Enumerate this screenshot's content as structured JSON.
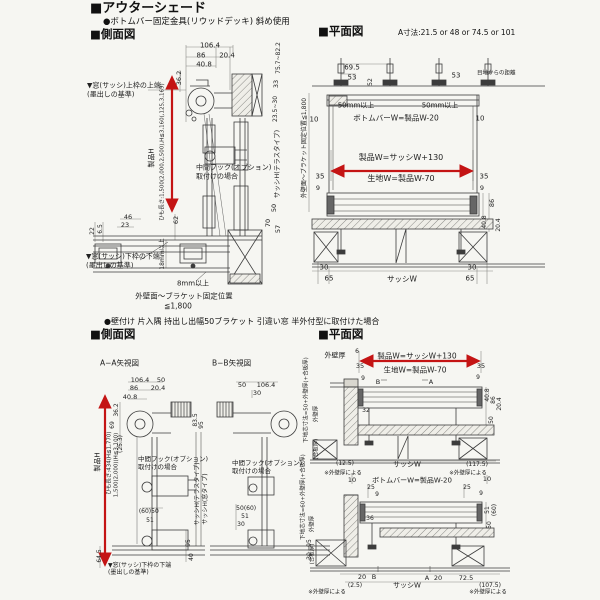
{
  "header": {
    "title": "■アウターシェード",
    "subtitle": "●ボトムバー固定金具(リウッドデッキ) 斜め使用"
  },
  "section1": {
    "side_label": "■側面図",
    "plan_label": "■平面図",
    "a_note": "A寸法:21.5 or 48 or 74.5 or 101"
  },
  "section2": {
    "heading": "●壁付け 片入隅 持出し出幅50ブラケット 引違い窓 半外付型に取付けた場合",
    "side_label": "■側面図",
    "plan_label": "■平面図"
  },
  "colors": {
    "line": "#3c3c3c",
    "dim": "#8a8a86",
    "red": "#c41414",
    "paper": "#f6f6f2"
  },
  "labels": [
    {
      "n": "sv1-dim-total-width",
      "t": "106.4",
      "x": 210,
      "y": 46,
      "s": 7
    },
    {
      "n": "sv1-dim-86",
      "t": "86",
      "x": 201,
      "y": 56,
      "s": 7
    },
    {
      "n": "sv1-dim-20-4",
      "t": "20.4",
      "x": 227,
      "y": 56,
      "s": 7
    },
    {
      "n": "sv1-dim-40-8",
      "t": "40.8",
      "x": 204,
      "y": 65,
      "s": 7
    },
    {
      "n": "sv1-dim-36-2",
      "t": "36.2",
      "x": 179,
      "y": 78,
      "s": 6.5,
      "r": 1
    },
    {
      "n": "sv1-note-upper-1",
      "t": "▼窓(サッシ)上枠の上端",
      "x": 87,
      "y": 86,
      "s": 7,
      "a": "l"
    },
    {
      "n": "sv1-note-upper-2",
      "t": "(墨出しの基準)",
      "x": 87,
      "y": 95,
      "s": 7,
      "a": "l"
    },
    {
      "n": "sv1-product-h",
      "t": "製品H",
      "x": 152,
      "y": 158,
      "s": 7,
      "r": 1
    },
    {
      "n": "sv1-cord-length",
      "t": "ひも長さ:1,500(2,000,2,500),H≦3,160(,125,3,169)",
      "x": 163,
      "y": 152,
      "s": 5.5,
      "r": 1
    },
    {
      "n": "sv1-midhook-1",
      "t": "中間フック(オプション)",
      "x": 196,
      "y": 168,
      "s": 7,
      "a": "l"
    },
    {
      "n": "sv1-midhook-2",
      "t": "取付けの場合",
      "x": 196,
      "y": 177,
      "s": 7,
      "a": "l"
    },
    {
      "n": "sv1-note-lower-1",
      "t": "▼窓(サッシ)下枠の下端",
      "x": 86,
      "y": 257,
      "s": 7,
      "a": "l"
    },
    {
      "n": "sv1-note-lower-2",
      "t": "(墨出しの基準)",
      "x": 86,
      "y": 266,
      "s": 7,
      "a": "l"
    },
    {
      "n": "sv1-dim-46",
      "t": "46",
      "x": 128,
      "y": 217,
      "s": 6.5
    },
    {
      "n": "sv1-dim-23",
      "t": "23",
      "x": 125,
      "y": 225,
      "s": 6.5
    },
    {
      "n": "sv1-dim-22",
      "t": "22",
      "x": 93,
      "y": 231,
      "s": 6,
      "r": 1
    },
    {
      "n": "sv1-dim-6-5",
      "t": "6.5",
      "x": 101,
      "y": 229,
      "s": 6,
      "r": 1
    },
    {
      "n": "sv1-dim-62",
      "t": "62",
      "x": 176,
      "y": 220,
      "s": 6.5,
      "r": 1
    },
    {
      "n": "sv1-dim-18mm",
      "t": "18mm以上",
      "x": 163,
      "y": 254,
      "s": 6,
      "r": 1
    },
    {
      "n": "sv1-dim-8mm",
      "t": "8mm以上",
      "x": 193,
      "y": 284,
      "s": 7
    },
    {
      "n": "sv1-fix-note-1",
      "t": "外壁面〜ブラケット固定位置",
      "x": 184,
      "y": 296,
      "s": 7.5
    },
    {
      "n": "sv1-fix-note-2",
      "t": "≦1,800",
      "x": 178,
      "y": 306,
      "s": 7.5
    },
    {
      "n": "sv1-dim-75-7",
      "t": "75.7~82.2",
      "x": 279,
      "y": 58,
      "s": 6,
      "r": 1
    },
    {
      "n": "sv1-dim-33",
      "t": "33",
      "x": 276,
      "y": 84,
      "s": 6.5,
      "r": 1
    },
    {
      "n": "sv1-dim-23-5",
      "t": "23.5~30",
      "x": 276,
      "y": 109,
      "s": 6,
      "r": 1
    },
    {
      "n": "sv1-sash-h",
      "t": "サッシH(テラスタイプ)",
      "x": 277,
      "y": 164,
      "s": 6.5,
      "r": 1
    },
    {
      "n": "sv1-dim-50",
      "t": "50",
      "x": 274,
      "y": 208,
      "s": 6.5,
      "r": 1
    },
    {
      "n": "sv1-dim-70",
      "t": "70",
      "x": 268,
      "y": 223,
      "s": 6.5,
      "r": 1
    },
    {
      "n": "sv1-dim-57",
      "t": "57",
      "x": 278,
      "y": 229,
      "s": 6.5,
      "r": 1
    },
    {
      "n": "pv1-dim-69-5",
      "t": "69.5",
      "x": 352,
      "y": 68,
      "s": 7
    },
    {
      "n": "pv1-dim-53-left",
      "t": "53",
      "x": 352,
      "y": 78,
      "s": 7
    },
    {
      "n": "pv1-dim-52",
      "t": "52",
      "x": 371,
      "y": 82,
      "s": 6,
      "r": 1
    },
    {
      "n": "pv1-dim-53-right",
      "t": "53",
      "x": 456,
      "y": 76,
      "s": 7
    },
    {
      "n": "pv1-joint-note",
      "t": "目地からの距離",
      "x": 477,
      "y": 74,
      "s": 5.5,
      "a": "l"
    },
    {
      "n": "pv1-50mm-left",
      "t": "50mm以上",
      "x": 356,
      "y": 106,
      "s": 7
    },
    {
      "n": "pv1-50mm-right",
      "t": "50mm以上",
      "x": 440,
      "y": 106,
      "s": 7
    },
    {
      "n": "pv1-bottombar-w",
      "t": "ボトムバーW=製品W-20",
      "x": 396,
      "y": 118,
      "s": 7.5
    },
    {
      "n": "pv1-dim-10-left",
      "t": "10",
      "x": 314,
      "y": 120,
      "s": 7
    },
    {
      "n": "pv1-dim-10-right",
      "t": "10",
      "x": 480,
      "y": 119,
      "s": 7
    },
    {
      "n": "pv1-product-w",
      "t": "製品W=サッシW+130",
      "x": 401,
      "y": 158,
      "s": 8
    },
    {
      "n": "pv1-fabric-w",
      "t": "生地W=製品W-70",
      "x": 401,
      "y": 179,
      "s": 8
    },
    {
      "n": "pv1-dim-35-left",
      "t": "35",
      "x": 320,
      "y": 177,
      "s": 7
    },
    {
      "n": "pv1-dim-35-right",
      "t": "35",
      "x": 484,
      "y": 177,
      "s": 7
    },
    {
      "n": "pv1-dim-9-left",
      "t": "9",
      "x": 318,
      "y": 188,
      "s": 6.5
    },
    {
      "n": "pv1-dim-9-right",
      "t": "9",
      "x": 482,
      "y": 188,
      "s": 6.5
    },
    {
      "n": "pv1-dim-86",
      "t": "86",
      "x": 492,
      "y": 203,
      "s": 6.5,
      "r": 1
    },
    {
      "n": "pv1-dim-40-8",
      "t": "40.8",
      "x": 485,
      "y": 222,
      "s": 6,
      "r": 1
    },
    {
      "n": "pv1-dim-20-4",
      "t": "20.4",
      "x": 499,
      "y": 225,
      "s": 6,
      "r": 1
    },
    {
      "n": "pv1-dim-30-left",
      "t": "30",
      "x": 324,
      "y": 268,
      "s": 7
    },
    {
      "n": "pv1-dim-65-left",
      "t": "65",
      "x": 329,
      "y": 279,
      "s": 7
    },
    {
      "n": "pv1-sash-w",
      "t": "サッシW",
      "x": 402,
      "y": 279,
      "s": 7.5
    },
    {
      "n": "pv1-dim-30-right",
      "t": "30",
      "x": 472,
      "y": 268,
      "s": 7
    },
    {
      "n": "pv1-dim-65-right",
      "t": "65",
      "x": 470,
      "y": 279,
      "s": 7
    },
    {
      "n": "pv1-wall-fix-rot",
      "t": "外壁面〜ブラケット固定位置≦1,800",
      "x": 305,
      "y": 148,
      "s": 6,
      "r": 1
    },
    {
      "n": "ab-aa-title",
      "t": "A−A矢視図",
      "x": 100,
      "y": 363,
      "s": 7.5,
      "a": "l"
    },
    {
      "n": "ab-bb-title",
      "t": "B−B矢視図",
      "x": 212,
      "y": 363,
      "s": 7.5,
      "a": "l"
    },
    {
      "n": "ab-dim-106-4-a",
      "t": "106.4",
      "x": 140,
      "y": 380,
      "s": 6.5
    },
    {
      "n": "ab-dim-50-a",
      "t": "50",
      "x": 161,
      "y": 380,
      "s": 6.5
    },
    {
      "n": "ab-dim-86",
      "t": "86",
      "x": 134,
      "y": 388,
      "s": 6.5
    },
    {
      "n": "ab-dim-20-4",
      "t": "20.4",
      "x": 158,
      "y": 388,
      "s": 6.5
    },
    {
      "n": "ab-dim-40-8",
      "t": "40.8",
      "x": 130,
      "y": 397,
      "s": 6.5
    },
    {
      "n": "ab-dim-36-2",
      "t": "36.2",
      "x": 117,
      "y": 410,
      "s": 6,
      "r": 1
    },
    {
      "n": "ab-dim-69",
      "t": "69",
      "x": 113,
      "y": 425,
      "s": 6,
      "r": 1
    },
    {
      "n": "ab-dim-25-3",
      "t": "(25.3)",
      "x": 121,
      "y": 444,
      "s": 6,
      "r": 1
    },
    {
      "n": "ab-dim-83-5",
      "t": "83.5",
      "x": 196,
      "y": 420,
      "s": 6,
      "r": 1
    },
    {
      "n": "ab-dim-95-a",
      "t": "95",
      "x": 202,
      "y": 425,
      "s": 6,
      "r": 1
    },
    {
      "n": "ab-dim-50-b",
      "t": "50",
      "x": 242,
      "y": 385,
      "s": 6.5
    },
    {
      "n": "ab-dim-106-4-b",
      "t": "106.4",
      "x": 266,
      "y": 385,
      "s": 6.5
    },
    {
      "n": "ab-dim-30-b",
      "t": "30",
      "x": 257,
      "y": 393,
      "s": 6.5
    },
    {
      "n": "ab-midhook-a1",
      "t": "中間フック(オプション)",
      "x": 138,
      "y": 459,
      "s": 6.5,
      "a": "l"
    },
    {
      "n": "ab-midhook-a2",
      "t": "取付けの場合",
      "x": 138,
      "y": 467,
      "s": 6.5,
      "a": "l"
    },
    {
      "n": "ab-midhook-b1",
      "t": "中間フック(オプション)",
      "x": 232,
      "y": 463,
      "s": 6.5,
      "a": "l"
    },
    {
      "n": "ab-midhook-b2",
      "t": "取付けの場合",
      "x": 232,
      "y": 471,
      "s": 6.5,
      "a": "l"
    },
    {
      "n": "ab-product-h",
      "t": "製品H",
      "x": 98,
      "y": 462,
      "s": 7,
      "r": 1
    },
    {
      "n": "ab-cord-1",
      "t": "ひも長さ:434(H≦1,770)",
      "x": 110,
      "y": 463,
      "s": 5.5,
      "r": 1
    },
    {
      "n": "ab-cord-2",
      "t": "1,500(2,000)(H≦3,100)",
      "x": 117,
      "y": 465,
      "s": 5.5,
      "r": 1
    },
    {
      "n": "ab-dim-60-a",
      "t": "(60)",
      "x": 145,
      "y": 512,
      "s": 6
    },
    {
      "n": "ab-dim-50-c",
      "t": "50",
      "x": 155,
      "y": 512,
      "s": 6
    },
    {
      "n": "ab-dim-51-a",
      "t": "51",
      "x": 150,
      "y": 521,
      "s": 6
    },
    {
      "n": "ab-dim-95-b",
      "t": "95",
      "x": 189,
      "y": 543,
      "s": 6,
      "r": 1
    },
    {
      "n": "ab-dim-40",
      "t": "40",
      "x": 192,
      "y": 557,
      "s": 6,
      "r": 1
    },
    {
      "n": "ab-sash-h-terrace",
      "t": "サッシH(テラスタイプ)",
      "x": 198,
      "y": 494,
      "s": 6,
      "r": 1
    },
    {
      "n": "ab-sash-h-window",
      "t": "サッシH(窓タイプ)",
      "x": 206,
      "y": 499,
      "s": 6,
      "r": 1
    },
    {
      "n": "ab-dim-50-d",
      "t": "50",
      "x": 240,
      "y": 509,
      "s": 6
    },
    {
      "n": "ab-dim-60-b",
      "t": "(60)",
      "x": 250,
      "y": 509,
      "s": 6
    },
    {
      "n": "ab-dim-51-b",
      "t": "51",
      "x": 245,
      "y": 517,
      "s": 6
    },
    {
      "n": "ab-dim-30-c",
      "t": "30",
      "x": 241,
      "y": 525,
      "s": 6
    },
    {
      "n": "ab-dim-95-c",
      "t": "95",
      "x": 310,
      "y": 543,
      "s": 6,
      "r": 1
    },
    {
      "n": "ab-dim-30-d",
      "t": "30",
      "x": 310,
      "y": 556,
      "s": 6,
      "r": 1
    },
    {
      "n": "ab-dim-64-5",
      "t": "64.5",
      "x": 100,
      "y": 556,
      "s": 6,
      "r": 1
    },
    {
      "n": "ab-note-lower-1",
      "t": "▼窓(サッシ)下枠の下端",
      "x": 108,
      "y": 566,
      "s": 6,
      "a": "l"
    },
    {
      "n": "ab-note-lower-2",
      "t": "(墨出しの基準)",
      "x": 108,
      "y": 573,
      "s": 6,
      "a": "l"
    },
    {
      "n": "pv2-wall-label",
      "t": "外壁厚",
      "x": 335,
      "y": 356,
      "s": 7
    },
    {
      "n": "pv2-dim-6",
      "t": "6",
      "x": 357,
      "y": 352,
      "s": 6
    },
    {
      "n": "pv2-product-w",
      "t": "製品W=サッシW+130",
      "x": 417,
      "y": 356,
      "s": 7.5
    },
    {
      "n": "pv2-dim-35-left",
      "t": "35",
      "x": 360,
      "y": 366,
      "s": 6.5
    },
    {
      "n": "pv2-dim-35-right",
      "t": "35",
      "x": 481,
      "y": 366,
      "s": 6.5
    },
    {
      "n": "pv2-fabric-w",
      "t": "生地W=製品W-70",
      "x": 415,
      "y": 370,
      "s": 7.5
    },
    {
      "n": "pv2-dim-9-a",
      "t": "9",
      "x": 363,
      "y": 379,
      "s": 6
    },
    {
      "n": "pv2-dim-9-b",
      "t": "9",
      "x": 478,
      "y": 378,
      "s": 6
    },
    {
      "n": "pv2-section-mark-b1",
      "t": "B",
      "x": 378,
      "y": 382,
      "s": 6.5
    },
    {
      "n": "pv2-section-mark-a1",
      "t": "A",
      "x": 431,
      "y": 382,
      "s": 6.5
    },
    {
      "n": "pv2-dim-32",
      "t": "32",
      "x": 366,
      "y": 411,
      "s": 6
    },
    {
      "n": "pv2-dim-40-8",
      "t": "40.8",
      "x": 488,
      "y": 395,
      "s": 6,
      "r": 1
    },
    {
      "n": "pv2-dim-86",
      "t": "86",
      "x": 494,
      "y": 400,
      "s": 6,
      "r": 1
    },
    {
      "n": "pv2-dim-20-4",
      "t": "20.4",
      "x": 500,
      "y": 404,
      "s": 6,
      "r": 1
    },
    {
      "n": "pv2-dim-50-a",
      "t": "50",
      "x": 492,
      "y": 420,
      "s": 6,
      "r": 1
    },
    {
      "n": "pv2-dim-12-5",
      "t": "(12.5)",
      "x": 345,
      "y": 464,
      "s": 6
    },
    {
      "n": "pv2-sash-w-1",
      "t": "サッシW",
      "x": 407,
      "y": 465,
      "s": 7
    },
    {
      "n": "pv2-dim-117-5",
      "t": "(117.5)",
      "x": 477,
      "y": 465,
      "s": 6
    },
    {
      "n": "pv2-wall-note-a",
      "t": "※外壁厚による",
      "x": 343,
      "y": 474,
      "s": 5.5
    },
    {
      "n": "pv2-wall-note-b",
      "t": "※外壁厚による",
      "x": 468,
      "y": 474,
      "s": 5.5
    },
    {
      "n": "pv2-dim-10-left",
      "t": "10",
      "x": 352,
      "y": 480,
      "s": 6.5
    },
    {
      "n": "pv2-dim-10-right",
      "t": "10",
      "x": 487,
      "y": 479,
      "s": 6.5
    },
    {
      "n": "pv2-bottombar-w",
      "t": "ボトムバーW=製品W-20",
      "x": 412,
      "y": 481,
      "s": 7
    },
    {
      "n": "pv2-dim-25-left",
      "t": "25",
      "x": 371,
      "y": 488,
      "s": 6
    },
    {
      "n": "pv2-dim-25-right",
      "t": "25",
      "x": 467,
      "y": 488,
      "s": 6
    },
    {
      "n": "pv2-dim-9-c",
      "t": "9",
      "x": 377,
      "y": 495,
      "s": 6
    },
    {
      "n": "pv2-dim-9-d",
      "t": "9",
      "x": 481,
      "y": 494,
      "s": 6
    },
    {
      "n": "pv2-dim-36",
      "t": "36",
      "x": 370,
      "y": 519,
      "s": 6
    },
    {
      "n": "pv2-dim-51",
      "t": "51",
      "x": 488,
      "y": 510,
      "s": 6,
      "r": 1
    },
    {
      "n": "pv2-dim-60",
      "t": "(60)",
      "x": 495,
      "y": 510,
      "s": 6,
      "r": 1
    },
    {
      "n": "pv2-dim-50-b",
      "t": "50",
      "x": 490,
      "y": 525,
      "s": 6,
      "r": 1
    },
    {
      "n": "pv2-dim-20-a",
      "t": "20",
      "x": 362,
      "y": 577,
      "s": 6.5
    },
    {
      "n": "pv2-section-mark-b2",
      "t": "B",
      "x": 374,
      "y": 577,
      "s": 6.5
    },
    {
      "n": "pv2-section-mark-a2",
      "t": "A",
      "x": 427,
      "y": 578,
      "s": 6.5
    },
    {
      "n": "pv2-dim-20-b",
      "t": "20",
      "x": 438,
      "y": 578,
      "s": 6.5
    },
    {
      "n": "pv2-dim-72-5",
      "t": "72.5",
      "x": 466,
      "y": 578,
      "s": 6.5
    },
    {
      "n": "pv2-dim-2-5",
      "t": "(2.5)",
      "x": 355,
      "y": 586,
      "s": 6
    },
    {
      "n": "pv2-sash-w-2",
      "t": "サッシW",
      "x": 407,
      "y": 586,
      "s": 7
    },
    {
      "n": "pv2-dim-107-5",
      "t": "(107.5)",
      "x": 490,
      "y": 586,
      "s": 6
    },
    {
      "n": "pv2-wall-note-c",
      "t": "※外壁厚による",
      "x": 327,
      "y": 593,
      "s": 5.5
    },
    {
      "n": "pv2-wall-note-d",
      "t": "※外壁厚による",
      "x": 488,
      "y": 593,
      "s": 5.5
    },
    {
      "n": "pv2-base-core-a",
      "t": "下地芯寸法=50+外壁厚(+合板厚)",
      "x": 307,
      "y": 400,
      "s": 5.5,
      "r": 1
    },
    {
      "n": "pv2-wall-rot-a",
      "t": "外壁厚",
      "x": 317,
      "y": 414,
      "s": 5.5,
      "r": 1
    },
    {
      "n": "pv2-board-rot-a",
      "t": "(合板厚)",
      "x": 317,
      "y": 449,
      "s": 5.5,
      "r": 1
    },
    {
      "n": "pv2-base-core-b",
      "t": "下地芯寸法=60+外壁厚(+合板厚)",
      "x": 304,
      "y": 497,
      "s": 5.5,
      "r": 1
    },
    {
      "n": "pv2-wall-rot-b",
      "t": "外壁厚",
      "x": 313,
      "y": 524,
      "s": 5.5,
      "r": 1
    },
    {
      "n": "pv2-board-rot-b",
      "t": "(合板厚)",
      "x": 313,
      "y": 554,
      "s": 5.5,
      "r": 1
    }
  ]
}
